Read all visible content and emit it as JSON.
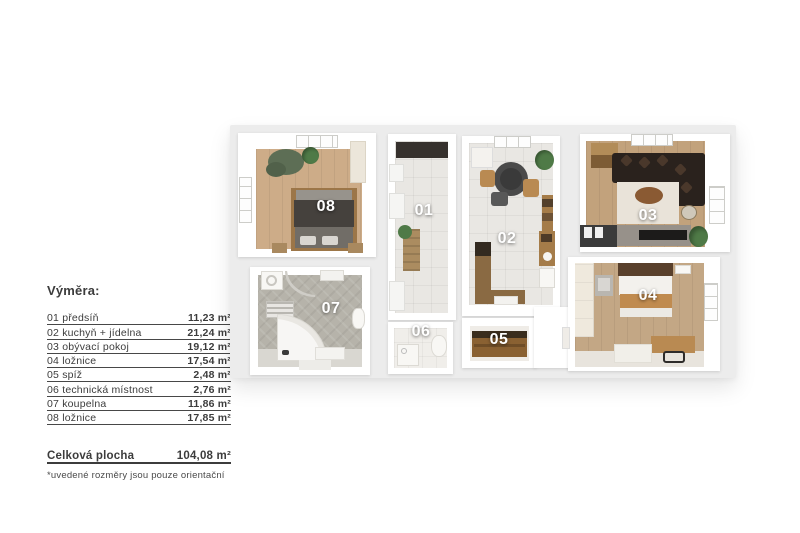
{
  "legend": {
    "title": "Výměra:",
    "rows": [
      {
        "label": "01 předsíň",
        "value": "11,23 m²"
      },
      {
        "label": "02 kuchyň + jídelna",
        "value": "21,24 m²"
      },
      {
        "label": "03 obývací pokoj",
        "value": "19,12 m²"
      },
      {
        "label": "04 ložnice",
        "value": "17,54 m²"
      },
      {
        "label": "05 spíž",
        "value": "2,48 m²"
      },
      {
        "label": "06 technická místnost",
        "value": "2,76 m²"
      },
      {
        "label": "07 koupelna",
        "value": "11,86 m²"
      },
      {
        "label": "08 ložnice",
        "value": "17,85 m²"
      }
    ],
    "total": {
      "label": "Celková plocha",
      "value": "104,08 m²"
    },
    "footnote": "*uvedené rozměry jsou pouze orientační"
  },
  "plan": {
    "rooms": [
      {
        "number": "01"
      },
      {
        "number": "02"
      },
      {
        "number": "03"
      },
      {
        "number": "04"
      },
      {
        "number": "05"
      },
      {
        "number": "06"
      },
      {
        "number": "07"
      },
      {
        "number": "08"
      }
    ]
  },
  "colors": {
    "text": "#3c3c3c",
    "slab": "#ececec",
    "wood_a": "#cdac88",
    "wood_b": "#c2a27c",
    "wood_c": "#c3a785",
    "tile": "#e9e7e3",
    "bath": "#b6b3aa",
    "sofa": "#2a221d",
    "label_white": "#ffffff"
  }
}
